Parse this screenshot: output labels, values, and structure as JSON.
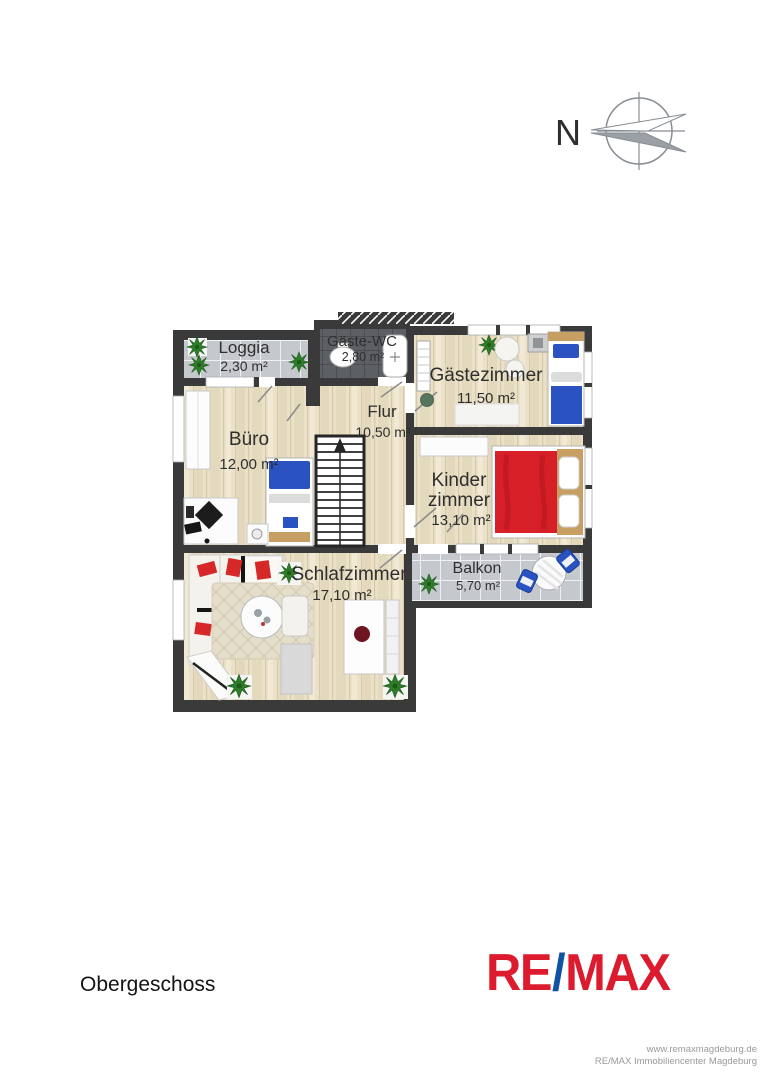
{
  "page": {
    "background": "#ffffff",
    "floor_label": "Obergeschoss"
  },
  "compass": {
    "north_label": "N"
  },
  "floorplan": {
    "rooms": {
      "loggia": {
        "name": "Loggia",
        "area": "2,30 m²"
      },
      "gaeste_wc": {
        "name": "Gäste-WC",
        "area": "2,80 m²"
      },
      "gaestezimmer": {
        "name": "Gästezimmer",
        "area": "11,50 m²"
      },
      "buero": {
        "name": "Büro",
        "area": "12,00 m²"
      },
      "flur": {
        "name": "Flur",
        "area": "10,50 m²"
      },
      "kinderzimmer": {
        "name_line1": "Kinder",
        "name_line2": "zimmer",
        "area": "13,10 m²"
      },
      "schlafzimmer": {
        "name": "Schlafzimmer",
        "area": "17,10 m²"
      },
      "balkon": {
        "name": "Balkon",
        "area": "5,70 m²"
      }
    }
  },
  "branding": {
    "logo": {
      "re": "RE",
      "slash": "/",
      "max": "MAX"
    },
    "website": "www.remaxmagdeburg.de",
    "company": "RE/MAX Immobiliencenter Magdeburg",
    "remax_red": "#dc1c2e",
    "remax_blue": "#1053a5"
  },
  "colors": {
    "wall": "#3a3a3a",
    "wood_floor": "#eae1c8",
    "balcony_tile": "#c5c9ce",
    "wc_tile": "#5c6064",
    "bed_blue": "#2a52c0",
    "bed_red": "#d61f26"
  }
}
